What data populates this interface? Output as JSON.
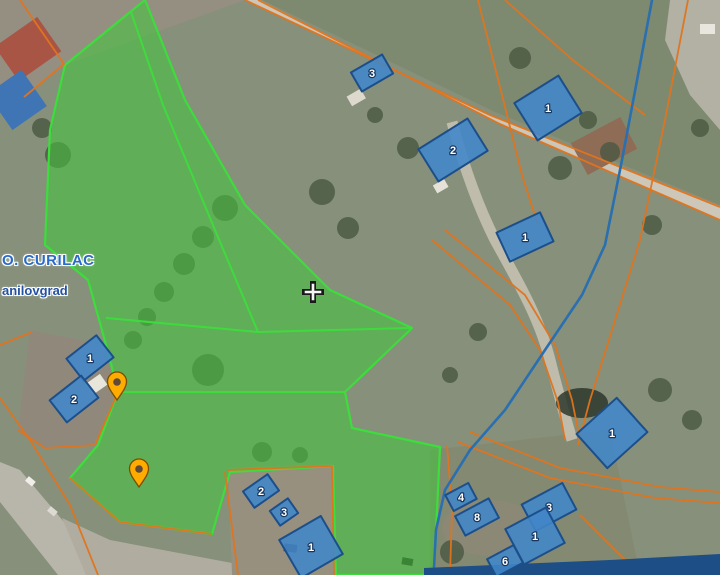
{
  "place_labels": {
    "primary": "O. CURILAC",
    "secondary": "anilovgrad"
  },
  "buildings": [
    {
      "label": "3"
    },
    {
      "label": "2"
    },
    {
      "label": "1"
    },
    {
      "label": "1"
    },
    {
      "label": "1"
    },
    {
      "label": "1"
    },
    {
      "label": "2"
    },
    {
      "label": "2"
    },
    {
      "label": "3"
    },
    {
      "label": "1"
    },
    {
      "label": "4"
    },
    {
      "label": "8"
    },
    {
      "label": "3"
    },
    {
      "label": "1"
    },
    {
      "label": "6"
    }
  ],
  "colors": {
    "parcel_fill": "#45c43e",
    "parcel_border": "#3ddd3d",
    "cadastral_line": "#e0741d",
    "building_fill": "#4186c9",
    "building_border": "#1c4f8a",
    "stream": "#2a6fb0",
    "pin": "#ffab00",
    "label_primary": "#2a6bc8",
    "label_secondary": "#2450a0"
  }
}
